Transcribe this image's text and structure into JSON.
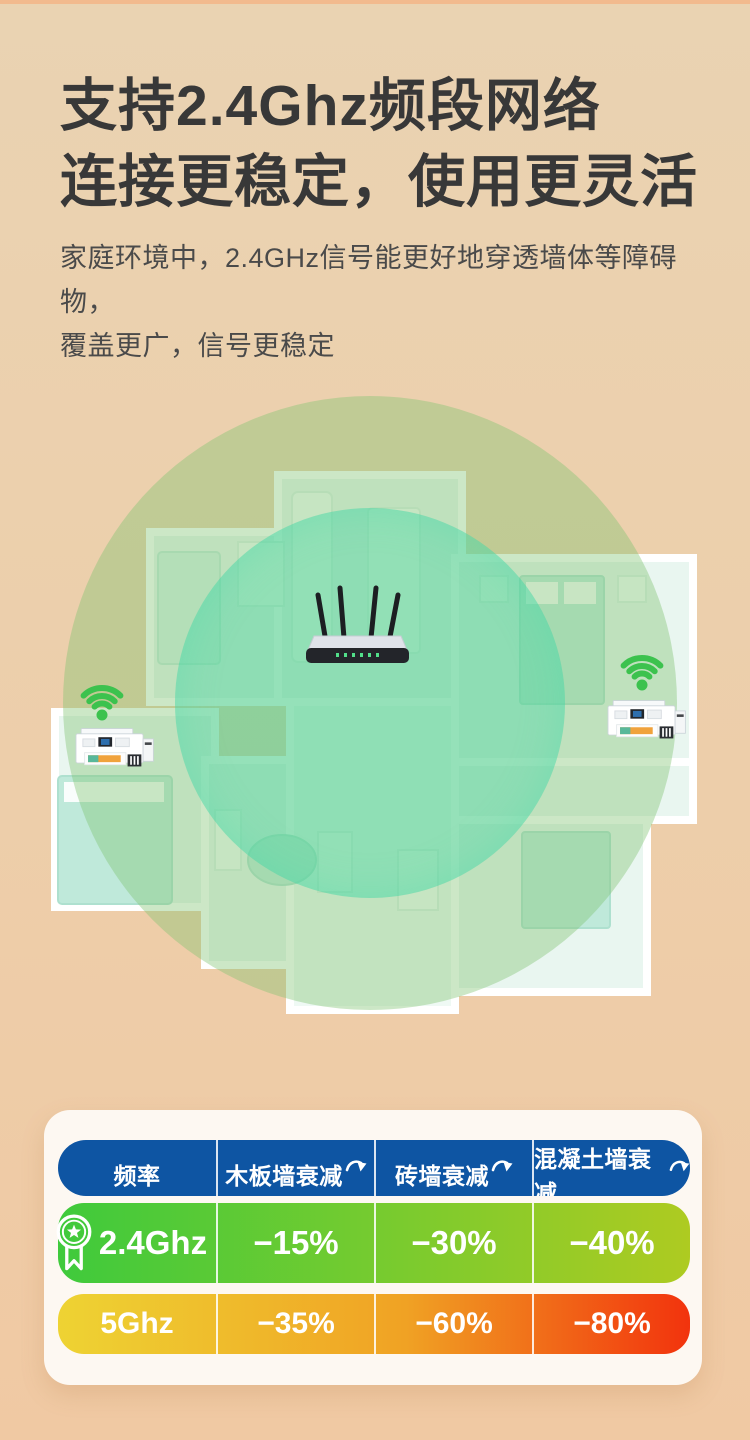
{
  "header": {
    "title_line1": "支持2.4Ghz频段网络",
    "title_line2": "连接更稳定，使用更灵活",
    "subtitle_line1": "家庭环境中，2.4GHz信号能更好地穿透墙体等障碍物，",
    "subtitle_line2": "覆盖更广，信号更稳定"
  },
  "illustration": {
    "icons": [
      "wifi-signal-icon",
      "router-device",
      "printer-device"
    ],
    "wifi_green": "#3cc24e",
    "coverage_outer_color": "rgba(128,194,112,0.40)",
    "coverage_inner_color": "rgba(74,218,168,0.42)"
  },
  "table": {
    "header_bg": "#0e55a3",
    "headers": [
      {
        "label": "频率",
        "has_sort_icon": false
      },
      {
        "label": "木板墙衰减",
        "has_sort_icon": true
      },
      {
        "label": "砖墙衰减",
        "has_sort_icon": true
      },
      {
        "label": "混凝土墙衰减",
        "has_sort_icon": true
      }
    ],
    "rows": [
      {
        "freq": "2.4Ghz",
        "badge": "medal-icon",
        "values": [
          "−15%",
          "−30%",
          "−40%"
        ],
        "gradient": [
          "#3fca3c",
          "#aecb21"
        ]
      },
      {
        "freq": "5Ghz",
        "badge": null,
        "values": [
          "−35%",
          "−60%",
          "−80%"
        ],
        "gradient": [
          "#eed333",
          "#f2330d"
        ]
      }
    ]
  },
  "chart_data": {
    "type": "table",
    "columns": [
      "频率",
      "木板墙衰减",
      "砖墙衰减",
      "混凝土墙衰减"
    ],
    "rows": [
      [
        "2.4Ghz",
        "−15%",
        "−30%",
        "−40%"
      ],
      [
        "5Ghz",
        "−35%",
        "−60%",
        "−80%"
      ]
    ],
    "highlighted_row": "2.4Ghz"
  }
}
